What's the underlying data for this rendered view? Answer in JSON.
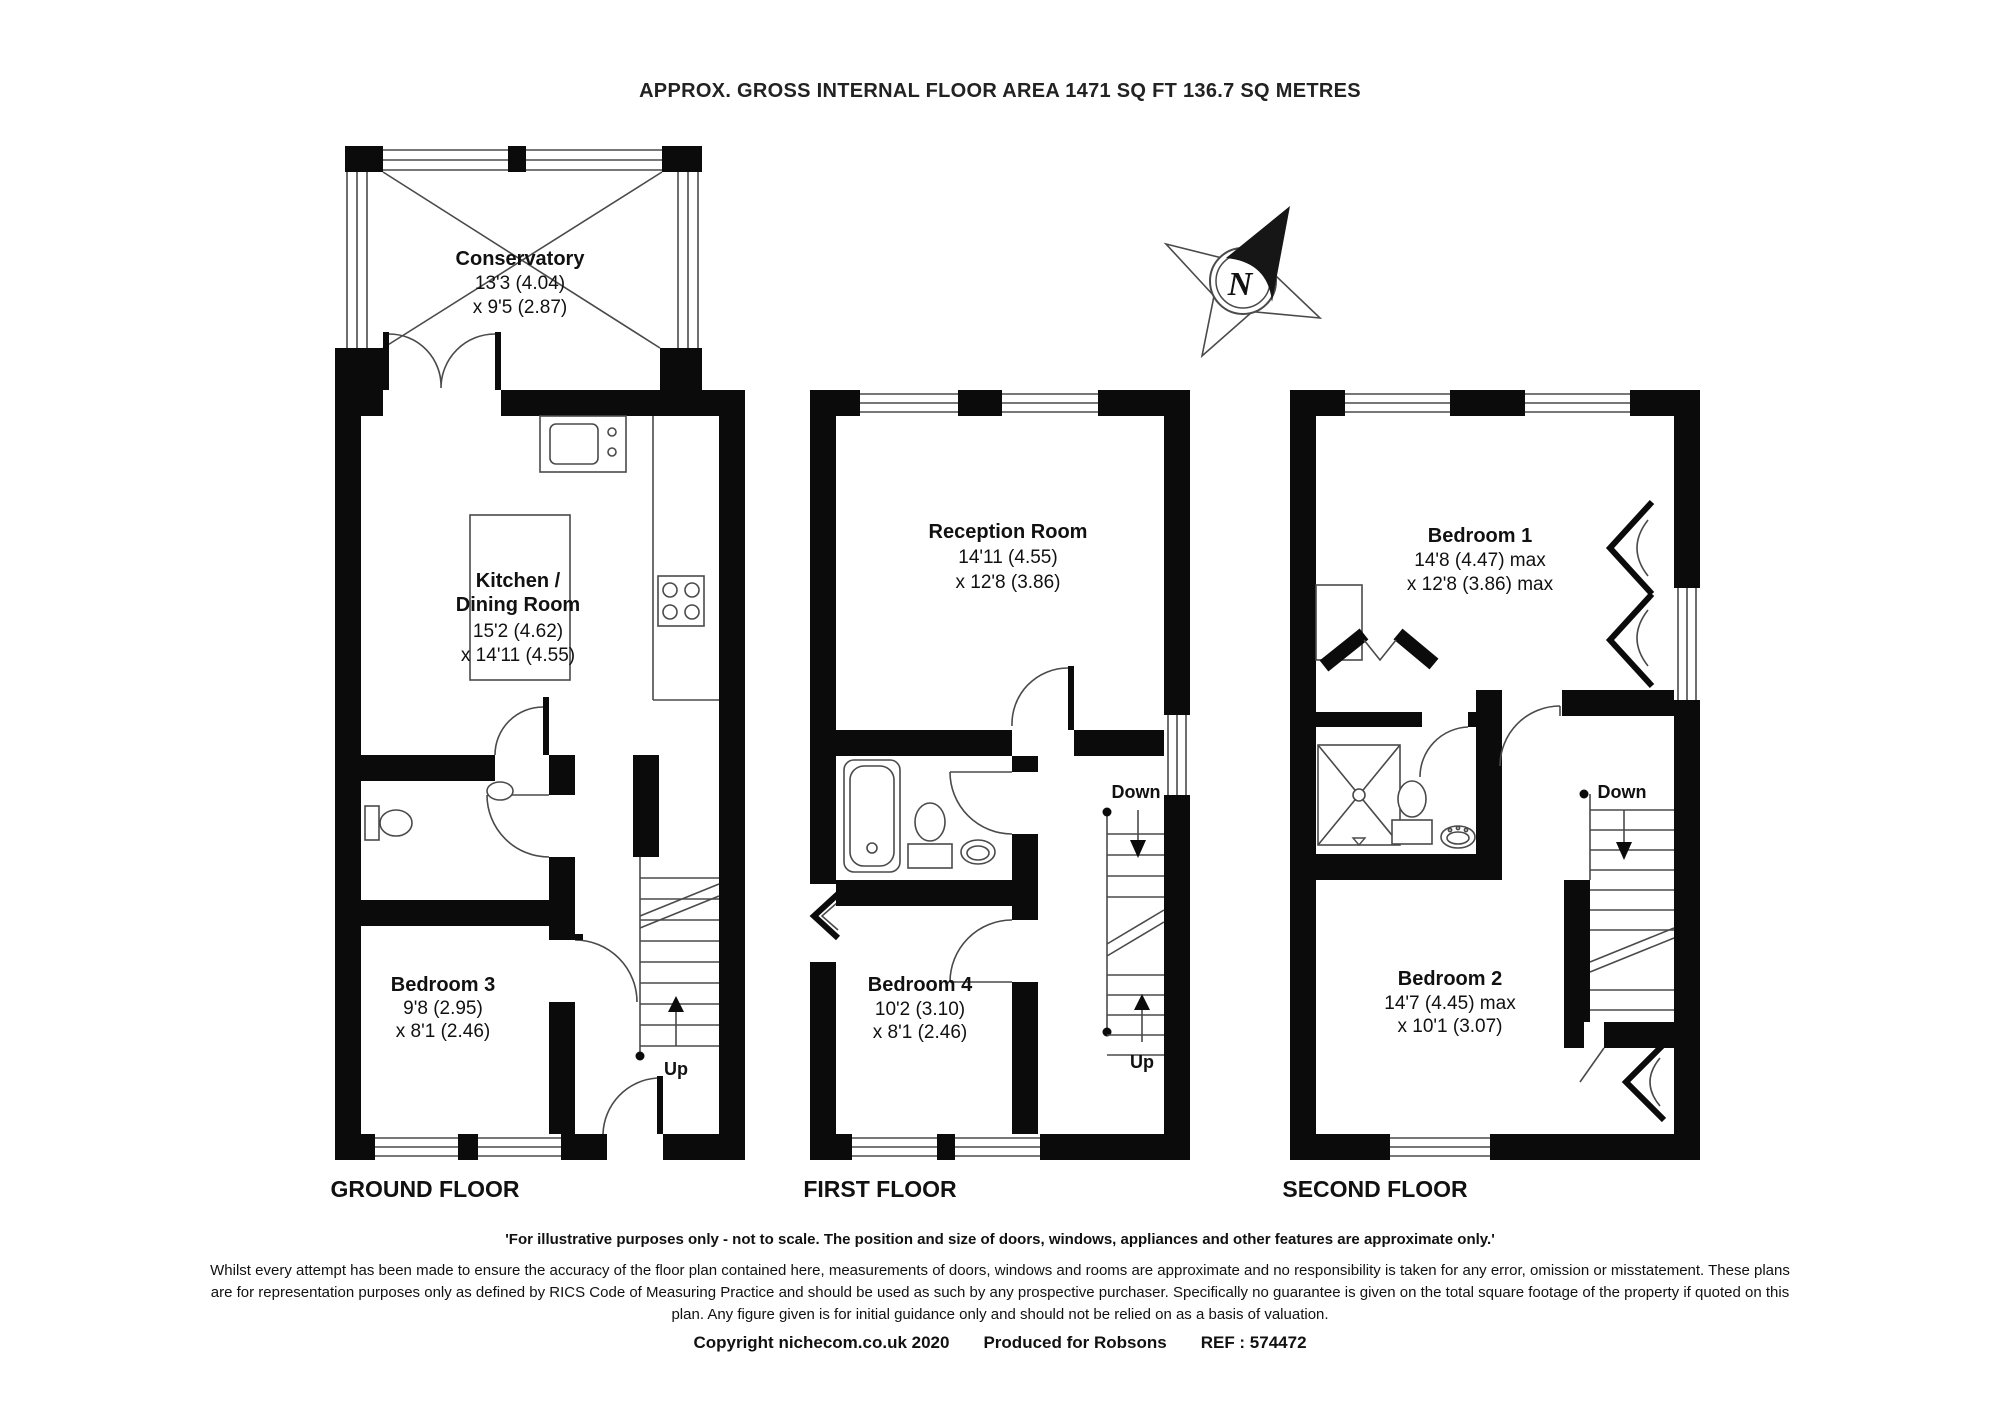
{
  "title": "APPROX. GROSS INTERNAL FLOOR AREA 1471 SQ FT 136.7 SQ METRES",
  "compass": {
    "north": "N"
  },
  "floors": {
    "ground": {
      "label": "GROUND FLOOR",
      "conservatory": {
        "name": "Conservatory",
        "dim1": "13'3 (4.04)",
        "dim2": "x 9'5 (2.87)"
      },
      "kitchen": {
        "name1": "Kitchen /",
        "name2": "Dining Room",
        "dim1": "15'2 (4.62)",
        "dim2": "x 14'11 (4.55)"
      },
      "bedroom3": {
        "name": "Bedroom 3",
        "dim1": "9'8 (2.95)",
        "dim2": "x 8'1 (2.46)"
      },
      "up": "Up"
    },
    "first": {
      "label": "FIRST FLOOR",
      "reception": {
        "name": "Reception Room",
        "dim1": "14'11 (4.55)",
        "dim2": "x 12'8 (3.86)"
      },
      "bedroom4": {
        "name": "Bedroom 4",
        "dim1": "10'2 (3.10)",
        "dim2": "x 8'1 (2.46)"
      },
      "down": "Down",
      "up": "Up"
    },
    "second": {
      "label": "SECOND FLOOR",
      "bedroom1": {
        "name": "Bedroom 1",
        "dim1": "14'8 (4.47) max",
        "dim2": "x 12'8 (3.86) max"
      },
      "bedroom2": {
        "name": "Bedroom 2",
        "dim1": "14'7 (4.45) max",
        "dim2": "x 10'1 (3.07)"
      },
      "down": "Down"
    }
  },
  "footer": {
    "notice": "'For illustrative purposes only - not to scale.  The position and size of doors, windows, appliances and other features are approximate only.'",
    "disclaimer": "Whilst every attempt has been made to ensure the accuracy of the floor plan contained here, measurements of doors, windows and rooms are approximate and no responsibility is taken for any error, omission or misstatement. These plans are for representation purposes only as defined by RICS Code of Measuring Practice and should be used as such by any prospective purchaser. Specifically no guarantee is given on the total square footage of the property if quoted on this plan. Any figure given is for initial guidance only and should not be relied on as a basis of valuation.",
    "copyright": "Copyright nichecom.co.uk 2020",
    "produced": "Produced for Robsons",
    "ref": "REF : 574472"
  },
  "colors": {
    "wall": "#0b0b0b",
    "line": "#4a4a4a",
    "text": "#1c1c1c",
    "background": "#ffffff"
  }
}
